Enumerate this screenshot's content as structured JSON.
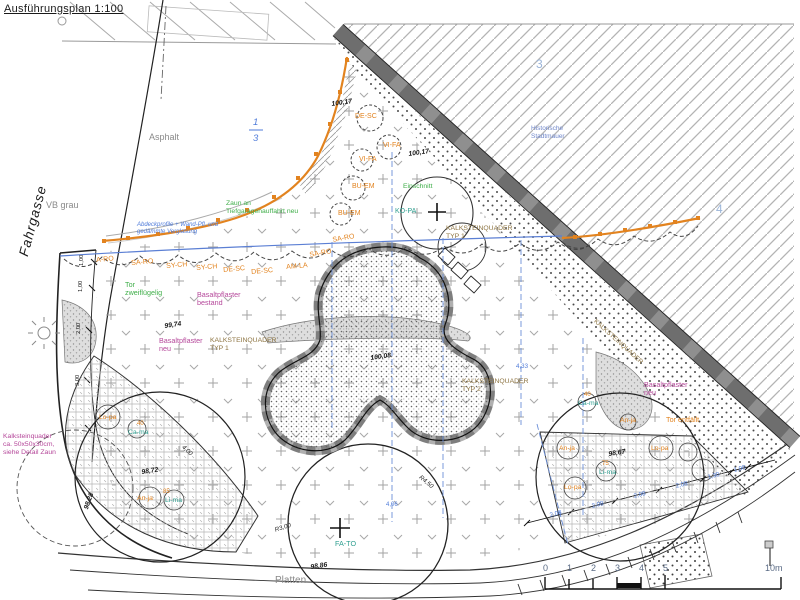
{
  "title": "Ausführungsplan 1:100",
  "colors": {
    "ink": "#1a1a1a",
    "gray": "#8a8a8a",
    "orange": "#e2831f",
    "teal": "#2e9e8f",
    "green": "#3fae49",
    "mag": "#b5479a",
    "blue": "#4f7bd9",
    "lblue": "#9ab4d8",
    "bgray": "#6f86c9",
    "kalk": "#8c7340"
  },
  "scalebar": {
    "ticks": [
      "0",
      "1",
      "2",
      "3",
      "4",
      "5"
    ],
    "end_label": "10m"
  },
  "labels": [
    {
      "n": "street-fahrgasse",
      "t": "Fahrgasse",
      "x": 16,
      "y": 254,
      "c": "ink",
      "s": 13.5,
      "i": 1,
      "r": -75,
      "ls": 1
    },
    {
      "n": "vb-grau",
      "t": "VB grau",
      "x": 46,
      "y": 200,
      "c": "gray",
      "s": 9
    },
    {
      "n": "asphalt",
      "t": "Asphalt",
      "x": 149,
      "y": 132,
      "c": "gray",
      "s": 9
    },
    {
      "n": "frac-num",
      "t": "1",
      "x": 253,
      "y": 117,
      "c": "blue",
      "s": 9.5,
      "i": 1
    },
    {
      "n": "frac-den",
      "t": "3",
      "x": 253,
      "y": 133,
      "c": "blue",
      "s": 9.5,
      "i": 1
    },
    {
      "n": "region-3",
      "t": "3",
      "x": 536,
      "y": 57,
      "c": "lblue",
      "s": 12
    },
    {
      "n": "region-4",
      "t": "4",
      "x": 716,
      "y": 202,
      "c": "lblue",
      "s": 12
    },
    {
      "n": "hist-stadtmauer",
      "t": "Historische\nStadtmauer",
      "x": 531,
      "y": 125,
      "c": "bgray",
      "s": 6.5
    },
    {
      "n": "zaun-tiefgarage",
      "t": "Zaun an\nTiefgaragenauffahrt neu",
      "x": 226,
      "y": 200,
      "c": "green",
      "s": 6.8
    },
    {
      "n": "abdeckprofile-note",
      "t": "Abdeckprofile + Wand-Pfl. und\ngedämmte Verglasung",
      "x": 137,
      "y": 222,
      "c": "blue",
      "s": 6,
      "i": 1
    },
    {
      "n": "tor-zweifluegelig",
      "t": "Tor\nzweiflügelig",
      "x": 125,
      "y": 281,
      "c": "green",
      "s": 7.2
    },
    {
      "n": "basalt-bestand",
      "t": "Basaltpflaster\nbestand",
      "x": 197,
      "y": 291,
      "c": "mag",
      "s": 7.2
    },
    {
      "n": "basalt-neu-1",
      "t": "Basaltpflaster\nneu",
      "x": 159,
      "y": 337,
      "c": "mag",
      "s": 7.2
    },
    {
      "n": "basalt-neu-2",
      "t": "Basaltpflaster\nneu",
      "x": 644,
      "y": 381,
      "c": "mag",
      "s": 7.2
    },
    {
      "n": "kalk-note",
      "t": "Kalksteinquader\nca. 50x50x30cm,\nsiehe Detail Zaun",
      "x": 3,
      "y": 433,
      "c": "mag",
      "s": 6.8
    },
    {
      "n": "ksq-typ1-a",
      "t": "KALKSTEINQUADER\nTYP 1",
      "x": 446,
      "y": 225,
      "c": "kalk",
      "s": 6.8
    },
    {
      "n": "ksq-typ1-b",
      "t": "KALKSTEINQUADER\nTYP 1",
      "x": 210,
      "y": 337,
      "c": "kalk",
      "s": 6.8
    },
    {
      "n": "ksq-typ2",
      "t": "KALKSTEINQUADER\nTYP 2",
      "x": 462,
      "y": 378,
      "c": "kalk",
      "s": 6.8
    },
    {
      "n": "ksq-wall",
      "t": "KALKSTEINQUADER",
      "x": 597,
      "y": 318,
      "c": "kalk",
      "s": 6.5,
      "r": 42
    },
    {
      "n": "einschnitt",
      "t": "Einschnitt",
      "x": 403,
      "y": 183,
      "c": "green",
      "s": 6.8
    },
    {
      "n": "tor-entfaellt",
      "t": "Tor entfällt",
      "x": 666,
      "y": 416,
      "c": "orange",
      "s": 7.2
    },
    {
      "n": "platten",
      "t": "Platten",
      "x": 275,
      "y": 575,
      "c": "gray",
      "s": 10
    },
    {
      "n": "plant-a-ro",
      "t": "A-RO",
      "x": 96,
      "y": 257,
      "c": "orange",
      "s": 7,
      "r": -5
    },
    {
      "n": "plant-sa-ro-1",
      "t": "SA-RO",
      "x": 131,
      "y": 260,
      "c": "orange",
      "s": 7,
      "r": -5
    },
    {
      "n": "plant-sy-ch-1",
      "t": "SY-CH",
      "x": 166,
      "y": 263,
      "c": "orange",
      "s": 7,
      "r": -5
    },
    {
      "n": "plant-sy-ch-2",
      "t": "SY-CH",
      "x": 196,
      "y": 265,
      "c": "orange",
      "s": 7,
      "r": -5
    },
    {
      "n": "plant-de-sc-1",
      "t": "DE-SC",
      "x": 223,
      "y": 267,
      "c": "orange",
      "s": 7,
      "r": -5
    },
    {
      "n": "plant-de-sc-2",
      "t": "DE-SC",
      "x": 251,
      "y": 269,
      "c": "orange",
      "s": 7,
      "r": -5
    },
    {
      "n": "plant-am-la",
      "t": "AM-LA",
      "x": 286,
      "y": 264,
      "c": "orange",
      "s": 7,
      "r": -5
    },
    {
      "n": "plant-sa-ro-2",
      "t": "SA-RO",
      "x": 309,
      "y": 252,
      "c": "orange",
      "s": 7,
      "r": -10
    },
    {
      "n": "plant-sa-ro-3",
      "t": "SA-RO",
      "x": 332,
      "y": 237,
      "c": "orange",
      "s": 7,
      "r": -10
    },
    {
      "n": "plant-de-sc-3",
      "t": "DE-SC",
      "x": 355,
      "y": 113,
      "c": "orange",
      "s": 7
    },
    {
      "n": "plant-vi-fa-1",
      "t": "VI-FA",
      "x": 383,
      "y": 142,
      "c": "orange",
      "s": 7
    },
    {
      "n": "plant-vi-fa-2",
      "t": "VI-FA",
      "x": 359,
      "y": 156,
      "c": "orange",
      "s": 7
    },
    {
      "n": "plant-bu-em-1",
      "t": "BU-EM",
      "x": 352,
      "y": 183,
      "c": "orange",
      "s": 7
    },
    {
      "n": "plant-bu-em-2",
      "t": "BU-EM",
      "x": 338,
      "y": 210,
      "c": "orange",
      "s": 7
    },
    {
      "n": "tree-ko-pa",
      "t": "KO-PA",
      "x": 395,
      "y": 208,
      "c": "teal",
      "s": 7
    },
    {
      "n": "tree-fa-to",
      "t": "FA-TO",
      "x": 335,
      "y": 540,
      "c": "teal",
      "s": 7.2
    },
    {
      "n": "bed1-lo-pa",
      "t": "Lo-pa",
      "x": 99,
      "y": 414,
      "c": "orange",
      "s": 6.8
    },
    {
      "n": "bed1-qty-40",
      "t": "40",
      "x": 137,
      "y": 421,
      "c": "orange",
      "s": 6
    },
    {
      "n": "bed1-ca-ma",
      "t": "Ca-ma",
      "x": 128,
      "y": 429,
      "c": "teal",
      "s": 6.8
    },
    {
      "n": "bed1-an-ja",
      "t": "An-ja",
      "x": 137,
      "y": 495,
      "c": "orange",
      "s": 6.8
    },
    {
      "n": "bed1-qty-85",
      "t": "85",
      "x": 163,
      "y": 489,
      "c": "orange",
      "s": 6
    },
    {
      "n": "bed1-li-ma",
      "t": "Li-ma",
      "x": 165,
      "y": 497,
      "c": "teal",
      "s": 6.8
    },
    {
      "n": "bed2-an-ja",
      "t": "An-ja",
      "x": 559,
      "y": 445,
      "c": "orange",
      "s": 6.8
    },
    {
      "n": "bed2-lo-pa-1",
      "t": "Lo-pa",
      "x": 651,
      "y": 445,
      "c": "orange",
      "s": 6.8
    },
    {
      "n": "bed2-qty-75",
      "t": "75",
      "x": 602,
      "y": 461,
      "c": "orange",
      "s": 6
    },
    {
      "n": "bed2-li-ma",
      "t": "Li-ma",
      "x": 599,
      "y": 469,
      "c": "teal",
      "s": 6.8
    },
    {
      "n": "bed2-lo-pa-2",
      "t": "Lo-pa",
      "x": 564,
      "y": 484,
      "c": "orange",
      "s": 6.8
    },
    {
      "n": "bed2-qty-40",
      "t": "40",
      "x": 584,
      "y": 392,
      "c": "orange",
      "s": 6
    },
    {
      "n": "bed2-ca-ma",
      "t": "Ca-ma",
      "x": 578,
      "y": 400,
      "c": "teal",
      "s": 6.8
    },
    {
      "n": "bed2-an-ja-2",
      "t": "An-ja",
      "x": 620,
      "y": 417,
      "c": "orange",
      "s": 6.8
    },
    {
      "n": "elev-100-17-a",
      "t": "100,17",
      "x": 331,
      "y": 101,
      "c": "ink",
      "s": 6.8,
      "b": 1,
      "i": 1,
      "r": -8
    },
    {
      "n": "elev-100-17-b",
      "t": "100,17",
      "x": 408,
      "y": 151,
      "c": "ink",
      "s": 6.8,
      "b": 1,
      "i": 1,
      "r": -8
    },
    {
      "n": "elev-99-74",
      "t": "99,74",
      "x": 164,
      "y": 323,
      "c": "ink",
      "s": 6.8,
      "b": 1,
      "i": 1,
      "r": -8
    },
    {
      "n": "elev-100-08",
      "t": "100,08",
      "x": 370,
      "y": 355,
      "c": "ink",
      "s": 6.8,
      "b": 1,
      "i": 1,
      "r": -8
    },
    {
      "n": "elev-98-72",
      "t": "98,72",
      "x": 141,
      "y": 469,
      "c": "ink",
      "s": 6.8,
      "b": 1,
      "i": 1,
      "r": -8
    },
    {
      "n": "elev-98-67",
      "t": "98,67",
      "x": 608,
      "y": 451,
      "c": "ink",
      "s": 6.8,
      "b": 1,
      "i": 1,
      "r": -8
    },
    {
      "n": "elev-98-86",
      "t": "98,86",
      "x": 310,
      "y": 564,
      "c": "ink",
      "s": 6.8,
      "b": 1,
      "i": 1,
      "r": -8
    },
    {
      "n": "elev-98-28",
      "t": "98,28",
      "x": 83,
      "y": 508,
      "c": "ink",
      "s": 6.8,
      "b": 1,
      "i": 1,
      "r": -70
    },
    {
      "n": "radius-r3",
      "t": "R3,00",
      "x": 274,
      "y": 527,
      "c": "ink",
      "s": 6.2,
      "i": 1,
      "r": -18
    },
    {
      "n": "radius-r4",
      "t": "R4,50",
      "x": 422,
      "y": 474,
      "c": "ink",
      "s": 6.2,
      "i": 1,
      "r": 40
    },
    {
      "n": "dim-4-00",
      "t": "4,00",
      "x": 185,
      "y": 444,
      "c": "ink",
      "s": 6.2,
      "i": 1,
      "r": 43
    },
    {
      "n": "dim-4-33",
      "t": "4,33",
      "x": 516,
      "y": 363,
      "c": "blue",
      "s": 6.2
    },
    {
      "n": "dim-2-08-1",
      "t": "2,08",
      "x": 549,
      "y": 512,
      "c": "blue",
      "s": 6.2,
      "r": -14
    },
    {
      "n": "dim-2-08-2",
      "t": "2,08",
      "x": 591,
      "y": 503,
      "c": "blue",
      "s": 6.2,
      "r": -14
    },
    {
      "n": "dim-2-08-3",
      "t": "2,08",
      "x": 633,
      "y": 493,
      "c": "blue",
      "s": 6.2,
      "r": -14
    },
    {
      "n": "dim-2-08-4",
      "t": "2,08",
      "x": 675,
      "y": 483,
      "c": "blue",
      "s": 6.2,
      "r": -14
    },
    {
      "n": "dim-1-30",
      "t": "1,30",
      "x": 707,
      "y": 474,
      "c": "blue",
      "s": 6.2,
      "r": -14
    },
    {
      "n": "dim-1-00-r",
      "t": "1,00",
      "x": 733,
      "y": 467,
      "c": "blue",
      "s": 6.2,
      "r": -14
    },
    {
      "n": "dim-4-06",
      "t": "4,06",
      "x": 386,
      "y": 502,
      "c": "blue",
      "s": 6
    },
    {
      "n": "chain-1-00-a",
      "t": "1,00",
      "x": 79,
      "y": 266,
      "c": "ink",
      "s": 5.8,
      "r": -90
    },
    {
      "n": "chain-1-00-b",
      "t": "1,00",
      "x": 78,
      "y": 292,
      "c": "ink",
      "s": 5.8,
      "r": -90
    },
    {
      "n": "chain-2-00",
      "t": "2,00",
      "x": 76,
      "y": 334,
      "c": "ink",
      "s": 5.8,
      "r": -90
    },
    {
      "n": "chain-3-00",
      "t": "3,00",
      "x": 75,
      "y": 386,
      "c": "ink",
      "s": 5.8,
      "r": -90
    }
  ]
}
